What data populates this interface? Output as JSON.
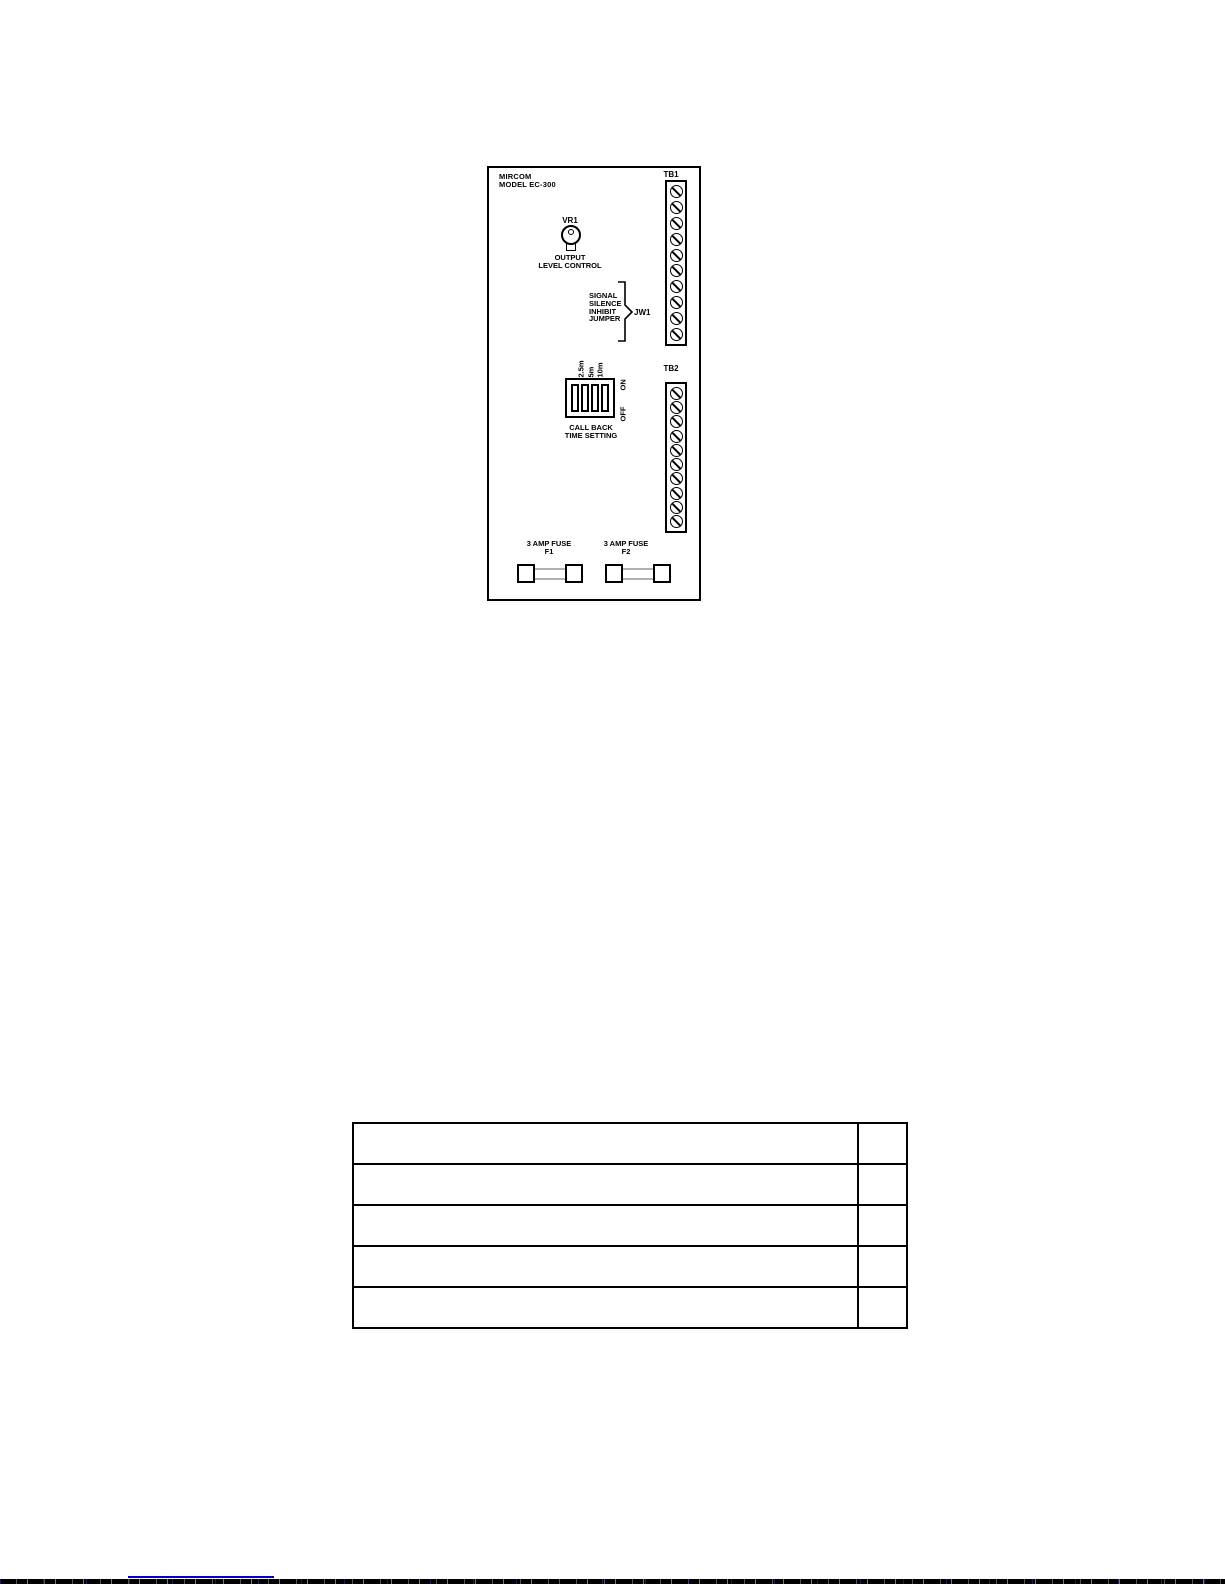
{
  "board": {
    "title_line1": "MIRCOM",
    "title_line2": "MODEL EC-300",
    "vr1": {
      "label": "VR1",
      "caption_line1": "OUTPUT",
      "caption_line2": "LEVEL CONTROL"
    },
    "jw1": {
      "lines": [
        "SIGNAL",
        "SILENCE",
        "INHIBIT",
        "JUMPER"
      ],
      "label": "JW1"
    },
    "dip": {
      "time_labels": [
        "2.5m",
        "5m",
        "10m"
      ],
      "on_label": "ON",
      "off_label": "OFF",
      "caption_line1": "CALL BACK",
      "caption_line2": "TIME SETTING",
      "positions": 4
    },
    "tb1": {
      "label": "TB1",
      "terminals": 10
    },
    "tb2": {
      "label": "TB2",
      "terminals": 10
    },
    "fuse1": {
      "caption": "3 AMP FUSE",
      "label": "F1"
    },
    "fuse2": {
      "caption": "3 AMP FUSE",
      "label": "F2"
    }
  },
  "table": {
    "rows": 5,
    "columns": 2
  },
  "colors": {
    "line": "#000000",
    "link_underline": "#0000cc"
  }
}
